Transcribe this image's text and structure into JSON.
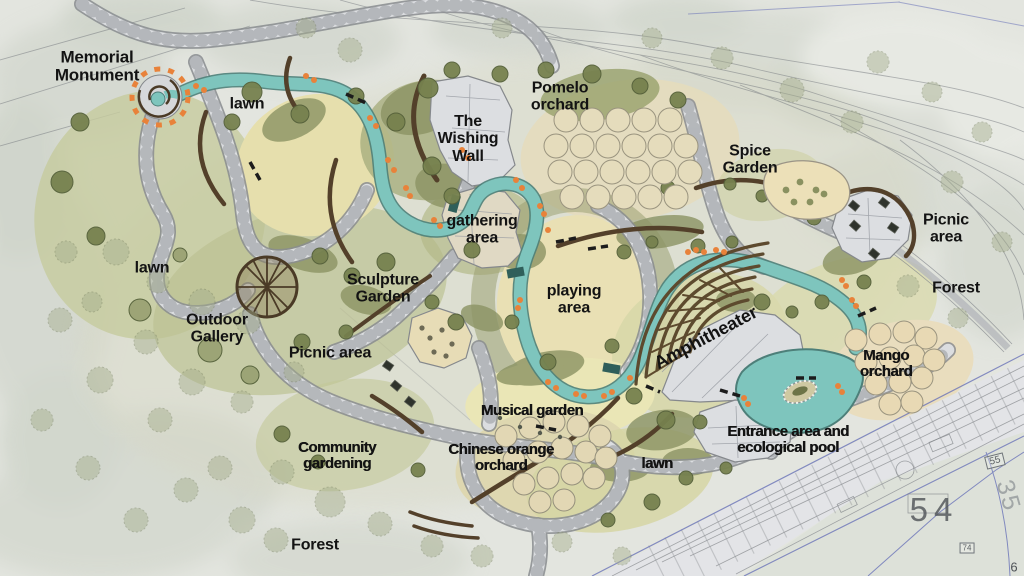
{
  "map": {
    "title": "Park landscape master plan",
    "area_labels": {
      "memorial_monument": "Memorial\nMonument",
      "lawn_nw": "lawn",
      "pomelo_orchard": "Pomelo\norchard",
      "wishing_wall": "The\nWishing\nWall",
      "spice_garden": "Spice\nGarden",
      "picnic_area_ne": "Picnic area",
      "forest_e": "Forest",
      "gathering_area": "gathering\narea",
      "lawn_w": "lawn",
      "sculpture_garden": "Sculpture\nGarden",
      "outdoor_gallery": "Outdoor\nGallery",
      "picnic_area_w": "Picnic area",
      "playing_area": "playing\narea",
      "amphitheater": "Amphitheater",
      "mango_orchard": "Mango\norchard",
      "entrance_pool": "Entrance area and\necological pool",
      "musical_garden": "Musical garden",
      "community_gardening": "Community\ngardening",
      "chinese_orange_orchard": "Chinese orange\norchard",
      "lawn_s": "lawn",
      "forest_sw": "Forest"
    },
    "cad_annotations": {
      "parcel_54": "54",
      "parcel_35": "35",
      "parcel_74": "74",
      "parcel_55": "55",
      "corner_6": "6"
    },
    "colors": {
      "water": "#7ec5bd",
      "path_stone": "#dbdde0",
      "lawn": "#e7e0ae",
      "vegetation_olive": "#8b9363",
      "wall_brown": "#53402a",
      "accent_orange": "#e8823a",
      "cad_blue": "#6a73b8",
      "background": "#e3e5df",
      "label_text": "#131313",
      "cad_text": "#4e5256"
    }
  }
}
